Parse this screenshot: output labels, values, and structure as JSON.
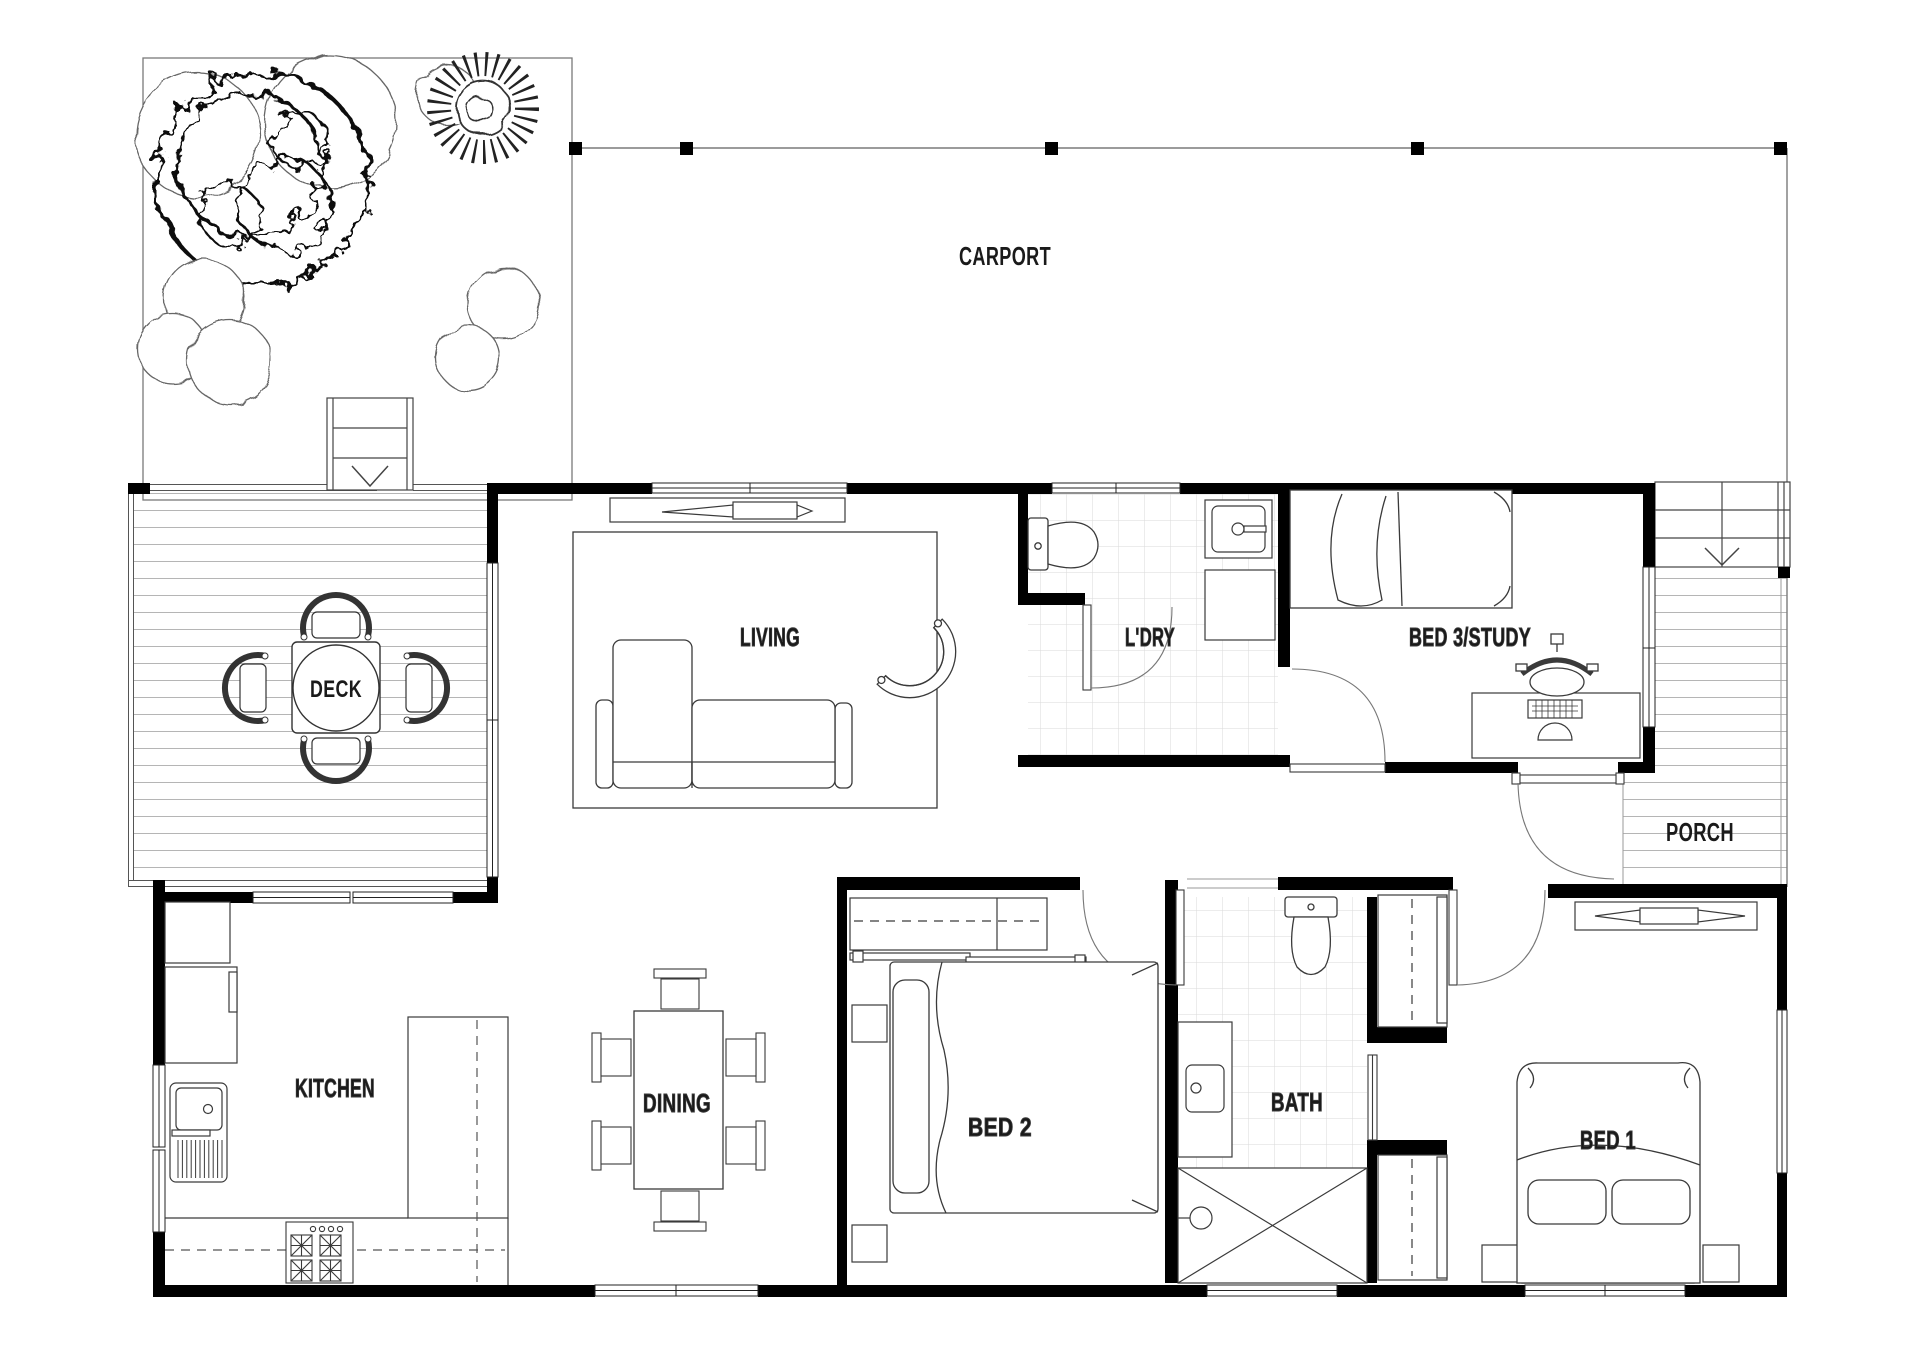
{
  "plan_title": "3 Bedroom House Floor Plan",
  "colors": {
    "wall": "#000000",
    "line": "#3a3a3a",
    "thin_line": "#8a8a8a",
    "deck_line": "#b5b5b5",
    "tile_line": "#dadada",
    "label": "#1a1a1a",
    "background": "#ffffff"
  },
  "rooms": {
    "carport": {
      "label": "CARPORT"
    },
    "deck": {
      "label": "DECK"
    },
    "living": {
      "label": "LIVING"
    },
    "laundry": {
      "label": "L'DRY"
    },
    "bed3": {
      "label": "BED 3/STUDY"
    },
    "porch": {
      "label": "PORCH"
    },
    "kitchen": {
      "label": "KITCHEN"
    },
    "dining": {
      "label": "DINING"
    },
    "bed2": {
      "label": "BED 2"
    },
    "bath": {
      "label": "BATH"
    },
    "bed1": {
      "label": "BED 1"
    }
  }
}
